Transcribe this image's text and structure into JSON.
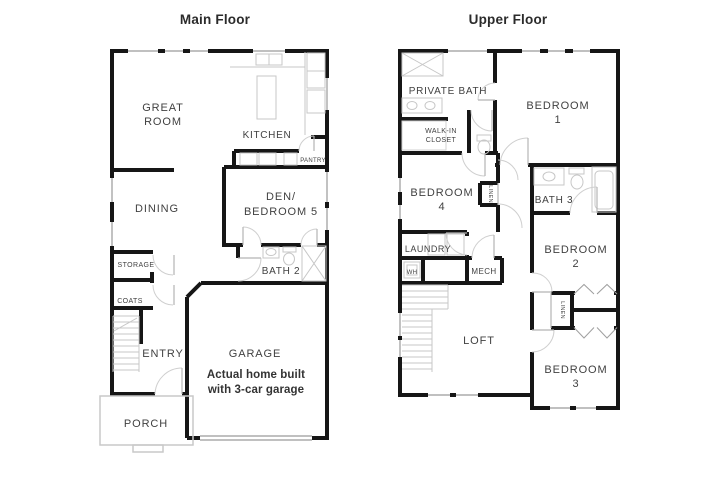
{
  "main_floor": {
    "title": "Main Floor",
    "rooms": {
      "great_room": [
        "GREAT",
        "ROOM"
      ],
      "kitchen": "KITCHEN",
      "pantry": "PANTRY",
      "dining": "DINING",
      "den": [
        "DEN/",
        "BEDROOM 5"
      ],
      "storage": "STORAGE",
      "coats": "COATS",
      "bath2": "BATH 2",
      "entry": "ENTRY",
      "garage": "GARAGE",
      "garage_note": [
        "Actual home built",
        "with 3-car garage"
      ],
      "porch": "PORCH"
    }
  },
  "upper_floor": {
    "title": "Upper Floor",
    "rooms": {
      "private_bath": "PRIVATE BATH",
      "walk_in_closet": [
        "WALK-IN",
        "CLOSET"
      ],
      "bedroom1": [
        "BEDROOM",
        "1"
      ],
      "bedroom4": [
        "BEDROOM",
        "4"
      ],
      "linen_hall": "LINEN",
      "bath3": "BATH 3",
      "laundry": "LAUNDRY",
      "water_heater": "WH",
      "mech": "MECH",
      "loft": "LOFT",
      "bedroom2": [
        "BEDROOM",
        "2"
      ],
      "linen_closet": "LINEN",
      "bedroom3": [
        "BEDROOM",
        "3"
      ]
    }
  }
}
